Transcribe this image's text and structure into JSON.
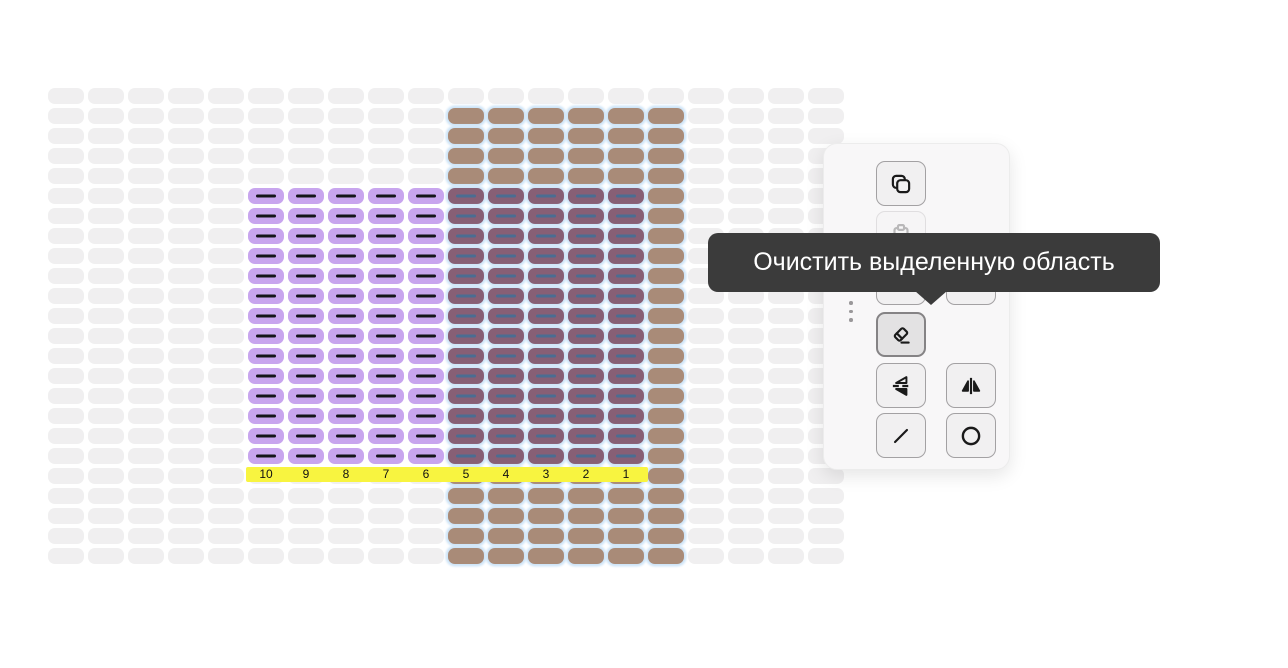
{
  "canvas": {
    "grid": {
      "cols": 20,
      "rows": 24,
      "cell_w": 36,
      "cell_h": 16,
      "pitch_x": 40,
      "pitch_y": 20,
      "origin_x": 48,
      "origin_y": 88
    },
    "colors": {
      "empty": "#f0eff0",
      "brown_yarn": "#a98b78",
      "purple_yarn": "#c8a5ee",
      "overlap_yarn": "#875f75",
      "dash_dark": "#15151a",
      "dash_blue": "#4a6d92",
      "selection_halo": "#cfe5f8",
      "ruler_bg": "#f8f440",
      "ruler_text": "#111111",
      "tooltip_bg": "#3b3b3b",
      "tooltip_text": "#ffffff"
    },
    "regions": {
      "brown_block": {
        "col_start": 10,
        "col_end": 15,
        "row_start": 1,
        "row_end": 23
      },
      "purple_block": {
        "col_start": 5,
        "col_end": 9,
        "row_start": 5,
        "row_end": 18
      },
      "overlap_block": {
        "col_start": 10,
        "col_end": 14,
        "row_start": 5,
        "row_end": 18
      },
      "selection": {
        "col_start": 10,
        "col_end": 15,
        "row_start": 1,
        "row_end": 23
      }
    },
    "ruler": {
      "row": 19,
      "numbers": [
        "10",
        "9",
        "8",
        "7",
        "6",
        "5",
        "4",
        "3",
        "2",
        "1"
      ]
    }
  },
  "toolbar": {
    "tooltip": {
      "text": "Очистить выделенную область"
    },
    "buttons": [
      {
        "id": "copy",
        "icon": "copy-icon",
        "state": "normal"
      },
      {
        "id": "paste",
        "icon": "paste-icon",
        "state": "disabled"
      },
      {
        "id": "hidden-left",
        "icon": "hidden",
        "state": "normal"
      },
      {
        "id": "hidden-right",
        "icon": "hidden",
        "state": "normal"
      },
      {
        "id": "eraser",
        "icon": "eraser-icon",
        "state": "active"
      },
      {
        "id": "flip-vertical",
        "icon": "flip-vertical-icon",
        "state": "normal"
      },
      {
        "id": "flip-horizontal",
        "icon": "flip-horizontal-icon",
        "state": "normal"
      },
      {
        "id": "line",
        "icon": "line-icon",
        "state": "normal"
      },
      {
        "id": "circle",
        "icon": "circle-icon",
        "state": "normal"
      }
    ]
  }
}
